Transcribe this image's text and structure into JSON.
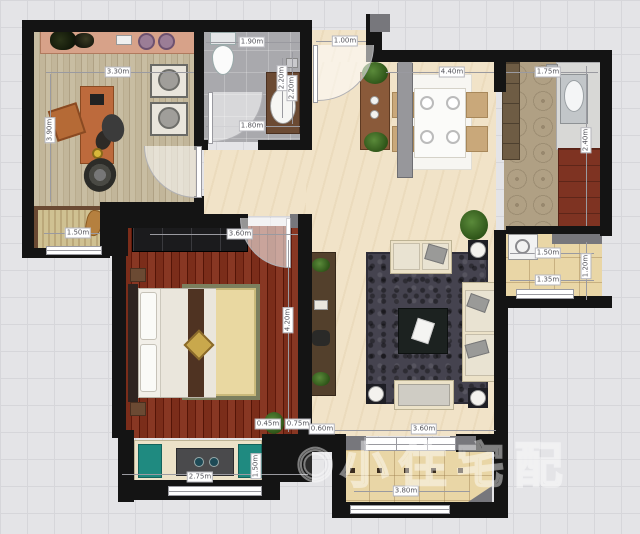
{
  "watermark": {
    "logo": "◉",
    "text": "小住宅配"
  },
  "dims": [
    {
      "text": "3.30m"
    },
    {
      "text": "3.90m"
    },
    {
      "text": "1.90m"
    },
    {
      "text": "2.20m"
    },
    {
      "text": "1.80m"
    },
    {
      "text": "1.00m"
    },
    {
      "text": "4.40m"
    },
    {
      "text": "1.75m"
    },
    {
      "text": "2.40m"
    },
    {
      "text": "1.50m"
    },
    {
      "text": "3.60m"
    },
    {
      "text": "4.20m"
    },
    {
      "text": "2.75m"
    },
    {
      "text": "0.45m"
    },
    {
      "text": "0.75m"
    },
    {
      "text": "0.60m"
    },
    {
      "text": "3.60m"
    },
    {
      "text": "3.80m"
    },
    {
      "text": "1.50m"
    },
    {
      "text": "1.35m"
    },
    {
      "text": "1.20m"
    },
    {
      "text": "2.20m"
    },
    {
      "text": "1.50m"
    }
  ],
  "colors": {
    "wall": "#141414",
    "floor_study": "#c2b69a",
    "floor_bath": "#a9a9ad",
    "floor_main": "#f1e3c8",
    "floor_kitchen": "#b0a084",
    "floor_bedroom": "#7b2d1a",
    "floor_balcony": "#e9d6a6",
    "rug_living": "#45434f",
    "rug_bedroom": "#e8d7a0",
    "sofa": "#ece2c8",
    "cushion_teal": "#1f8a80",
    "desk": "#bd6a3c",
    "tv_cabinet": "#53402c",
    "stove": "#7e3322",
    "plant": "#3f6b2a",
    "dim_line": "#9a9aa0"
  }
}
